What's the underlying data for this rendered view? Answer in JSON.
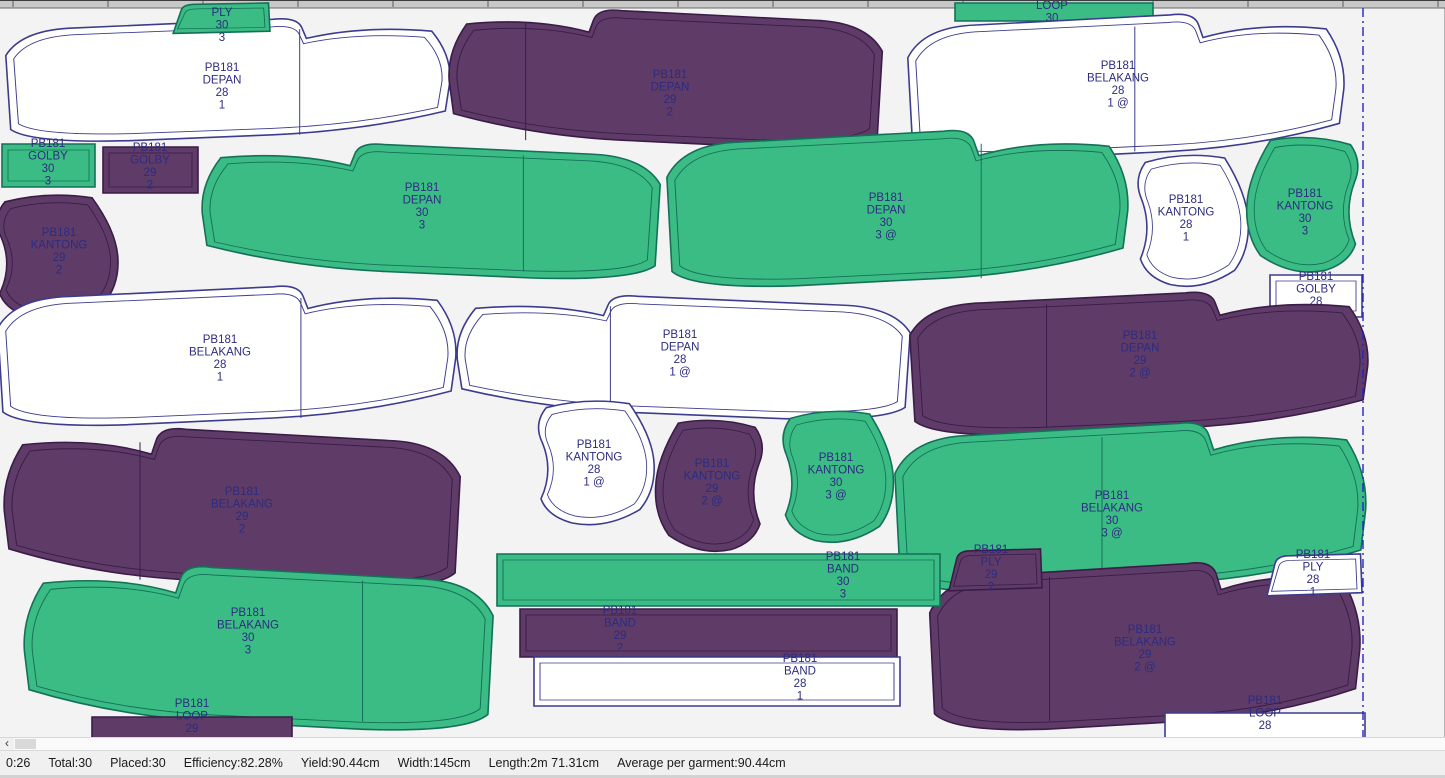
{
  "statusbar": {
    "items": [
      "0:26",
      "Total:30",
      "Placed:30",
      "Efficiency:82.28%",
      "Yield:90.44cm",
      "Width:145cm",
      "Length:2m 71.31cm",
      "Average per garment:90.44cm"
    ]
  },
  "icons": {
    "scroll_left_arrow": "‹"
  },
  "colors": {
    "background": "#f4f3f3",
    "label": "#2c2c80",
    "marker_end_line": "#2323c8",
    "ruler": "#c8c8c8",
    "green": {
      "fill": "#3bbc84",
      "stroke": "#14705a"
    },
    "purple": {
      "fill": "#5f3b68",
      "stroke": "#3a1c48"
    },
    "white": {
      "fill": "#ffffff",
      "stroke": "#3c3c8e"
    }
  },
  "marker": {
    "end_line_x": 1363,
    "ruler_tick_spacing": 95
  },
  "pieces": [
    {
      "id": "depan-28-top",
      "shape": "panel-r",
      "color": "white",
      "bbox": [
        4,
        15,
        448,
        132
      ],
      "seam": 0.66,
      "label": {
        "x": 222,
        "y": 70,
        "lines": [
          "PB181",
          "DEPAN",
          "28",
          "1"
        ]
      }
    },
    {
      "id": "depan-29-top",
      "shape": "panel-l",
      "color": "purple",
      "bbox": [
        447,
        6,
        437,
        148
      ],
      "seam": 0.18,
      "label": {
        "x": 670,
        "y": 77,
        "lines": [
          "PB181",
          "DEPAN",
          "29",
          "2"
        ]
      }
    },
    {
      "id": "ply-30",
      "shape": "trap",
      "color": "green",
      "bbox": [
        168,
        2,
        102,
        32
      ],
      "label": {
        "x": 222,
        "y": 15,
        "lines": [
          "PLY",
          "30",
          "3"
        ]
      }
    },
    {
      "id": "loop-30",
      "shape": "rect",
      "color": "green",
      "bbox": [
        955,
        2,
        198,
        18
      ],
      "label": {
        "x": 1052,
        "y": 8,
        "lines": [
          "LOOP",
          "30",
          "3"
        ]
      }
    },
    {
      "id": "belakang-28-top",
      "shape": "panel-r",
      "color": "white",
      "bbox": [
        906,
        10,
        440,
        156
      ],
      "seam": 0.52,
      "label": {
        "x": 1118,
        "y": 68,
        "lines": [
          "PB181",
          "BELAKANG",
          "28",
          "1 @"
        ]
      }
    },
    {
      "id": "depan-30-left",
      "shape": "panel-l",
      "color": "green",
      "bbox": [
        200,
        140,
        462,
        145
      ],
      "seam": 0.7,
      "label": {
        "x": 422,
        "y": 190,
        "lines": [
          "PB181",
          "DEPAN",
          "30",
          "3"
        ]
      }
    },
    {
      "id": "depan-30-right",
      "shape": "panel-r",
      "color": "green",
      "bbox": [
        665,
        126,
        465,
        168
      ],
      "seam": 0.68,
      "label": {
        "x": 886,
        "y": 200,
        "lines": [
          "PB181",
          "DEPAN",
          "30",
          "3 @"
        ]
      }
    },
    {
      "id": "golby-30",
      "shape": "rect2",
      "color": "green",
      "bbox": [
        2,
        143,
        93,
        43
      ],
      "label": {
        "x": 48,
        "y": 146,
        "lines": [
          "PB181",
          "GOLBY",
          "30",
          "3"
        ]
      }
    },
    {
      "id": "golby-29",
      "shape": "rect2",
      "color": "purple",
      "bbox": [
        103,
        146,
        95,
        46
      ],
      "label": {
        "x": 150,
        "y": 150,
        "lines": [
          "PB181",
          "GOLBY",
          "29",
          "2"
        ]
      }
    },
    {
      "id": "kantong-29",
      "shape": "pocket-l",
      "color": "purple",
      "bbox": [
        -14,
        190,
        136,
        135
      ],
      "label": {
        "x": 59,
        "y": 235,
        "lines": [
          "PB181",
          "KANTONG",
          "29",
          "2"
        ]
      }
    },
    {
      "id": "kantong-28-top",
      "shape": "pocket-l",
      "color": "white",
      "bbox": [
        1128,
        150,
        124,
        142
      ],
      "label": {
        "x": 1186,
        "y": 202,
        "lines": [
          "PB181",
          "KANTONG",
          "28",
          "1"
        ]
      }
    },
    {
      "id": "kantong-30-top",
      "shape": "pocket-r",
      "color": "green",
      "bbox": [
        1243,
        132,
        125,
        146
      ],
      "label": {
        "x": 1305,
        "y": 196,
        "lines": [
          "PB181",
          "KANTONG",
          "30",
          "3"
        ]
      }
    },
    {
      "id": "golby-28",
      "shape": "rect2",
      "color": "white",
      "bbox": [
        1270,
        274,
        92,
        42
      ],
      "label": {
        "x": 1316,
        "y": 279,
        "lines": [
          "PB181",
          "GOLBY",
          "28",
          "1"
        ]
      }
    },
    {
      "id": "belakang-28-mid",
      "shape": "panel-r",
      "color": "white",
      "bbox": [
        -4,
        282,
        462,
        150
      ],
      "seam": 0.66,
      "label": {
        "x": 220,
        "y": 342,
        "lines": [
          "PB181",
          "BELAKANG",
          "28",
          "1"
        ]
      }
    },
    {
      "id": "depan-28-mid",
      "shape": "panel-l",
      "color": "white",
      "bbox": [
        455,
        292,
        457,
        133
      ],
      "seam": 0.34,
      "label": {
        "x": 680,
        "y": 337,
        "lines": [
          "PB181",
          "DEPAN",
          "28",
          "1 @"
        ]
      }
    },
    {
      "id": "depan-29-mid",
      "shape": "panel-r",
      "color": "purple",
      "bbox": [
        908,
        288,
        462,
        154
      ],
      "seam": 0.3,
      "label": {
        "x": 1140,
        "y": 338,
        "lines": [
          "PB181",
          "DEPAN",
          "29",
          "2 @"
        ]
      }
    },
    {
      "id": "belakang-29-mid",
      "shape": "panel-l",
      "color": "purple",
      "bbox": [
        2,
        424,
        460,
        172
      ],
      "seam": 0.3,
      "label": {
        "x": 242,
        "y": 494,
        "lines": [
          "PB181",
          "BELAKANG",
          "29",
          "2"
        ]
      }
    },
    {
      "id": "kantong-28-mid",
      "shape": "pocket-l",
      "color": "white",
      "bbox": [
        528,
        396,
        130,
        134
      ],
      "label": {
        "x": 594,
        "y": 447,
        "lines": [
          "PB181",
          "KANTONG",
          "28",
          "1 @"
        ]
      }
    },
    {
      "id": "kantong-29-mid",
      "shape": "pocket-r",
      "color": "purple",
      "bbox": [
        652,
        415,
        120,
        142
      ],
      "label": {
        "x": 712,
        "y": 466,
        "lines": [
          "PB181",
          "KANTONG",
          "29",
          "2 @"
        ]
      }
    },
    {
      "id": "kantong-30-mid",
      "shape": "pocket-l",
      "color": "green",
      "bbox": [
        773,
        406,
        124,
        142
      ],
      "label": {
        "x": 836,
        "y": 460,
        "lines": [
          "PB181",
          "KANTONG",
          "30",
          "3 @"
        ]
      }
    },
    {
      "id": "belakang-30-right",
      "shape": "panel-r",
      "color": "green",
      "bbox": [
        893,
        418,
        475,
        182
      ],
      "seam": 0.44,
      "label": {
        "x": 1112,
        "y": 498,
        "lines": [
          "PB181",
          "BELAKANG",
          "30",
          "3 @"
        ]
      }
    },
    {
      "id": "belakang-30-bottom",
      "shape": "panel-l",
      "color": "green",
      "bbox": [
        22,
        562,
        473,
        176
      ],
      "seam": 0.72,
      "label": {
        "x": 248,
        "y": 615,
        "lines": [
          "PB181",
          "BELAKANG",
          "30",
          "3"
        ]
      }
    },
    {
      "id": "belakang-29-bottom",
      "shape": "panel-r",
      "color": "purple",
      "bbox": [
        928,
        558,
        434,
        180
      ],
      "seam": 0.28,
      "label": {
        "x": 1145,
        "y": 632,
        "lines": [
          "PB181",
          "BELAKANG",
          "29",
          "2 @"
        ]
      }
    },
    {
      "id": "band-30",
      "shape": "rect2",
      "color": "green",
      "bbox": [
        497,
        553,
        443,
        52
      ],
      "label": {
        "x": 843,
        "y": 559,
        "lines": [
          "PB181",
          "BAND",
          "30",
          "3"
        ]
      }
    },
    {
      "id": "band-29",
      "shape": "rect2",
      "color": "purple",
      "bbox": [
        520,
        608,
        377,
        48
      ],
      "label": {
        "x": 620,
        "y": 613,
        "lines": [
          "PB181",
          "BAND",
          "29",
          "2"
        ]
      }
    },
    {
      "id": "band-28",
      "shape": "rect2",
      "color": "white",
      "bbox": [
        534,
        656,
        366,
        49
      ],
      "label": {
        "x": 800,
        "y": 661,
        "lines": [
          "PB181",
          "BAND",
          "28",
          "1"
        ]
      }
    },
    {
      "id": "ply-29",
      "shape": "trap",
      "color": "purple",
      "bbox": [
        944,
        548,
        98,
        44
      ],
      "label": {
        "x": 991,
        "y": 552,
        "lines": [
          "PB181",
          "PLY",
          "29",
          "2"
        ]
      }
    },
    {
      "id": "ply-28",
      "shape": "trap",
      "color": "white",
      "bbox": [
        1262,
        553,
        100,
        44
      ],
      "label": {
        "x": 1313,
        "y": 557,
        "lines": [
          "PB181",
          "PLY",
          "28",
          "1"
        ]
      }
    },
    {
      "id": "loop-29",
      "shape": "rect",
      "color": "purple",
      "bbox": [
        92,
        716,
        200,
        24
      ],
      "label": {
        "x": 192,
        "y": 706,
        "lines": [
          "PB181",
          "LOOP",
          "29"
        ]
      }
    },
    {
      "id": "loop-28",
      "shape": "rect",
      "color": "white",
      "bbox": [
        1165,
        712,
        200,
        26
      ],
      "label": {
        "x": 1265,
        "y": 703,
        "lines": [
          "PB181",
          "LOOP",
          "28"
        ]
      }
    }
  ]
}
